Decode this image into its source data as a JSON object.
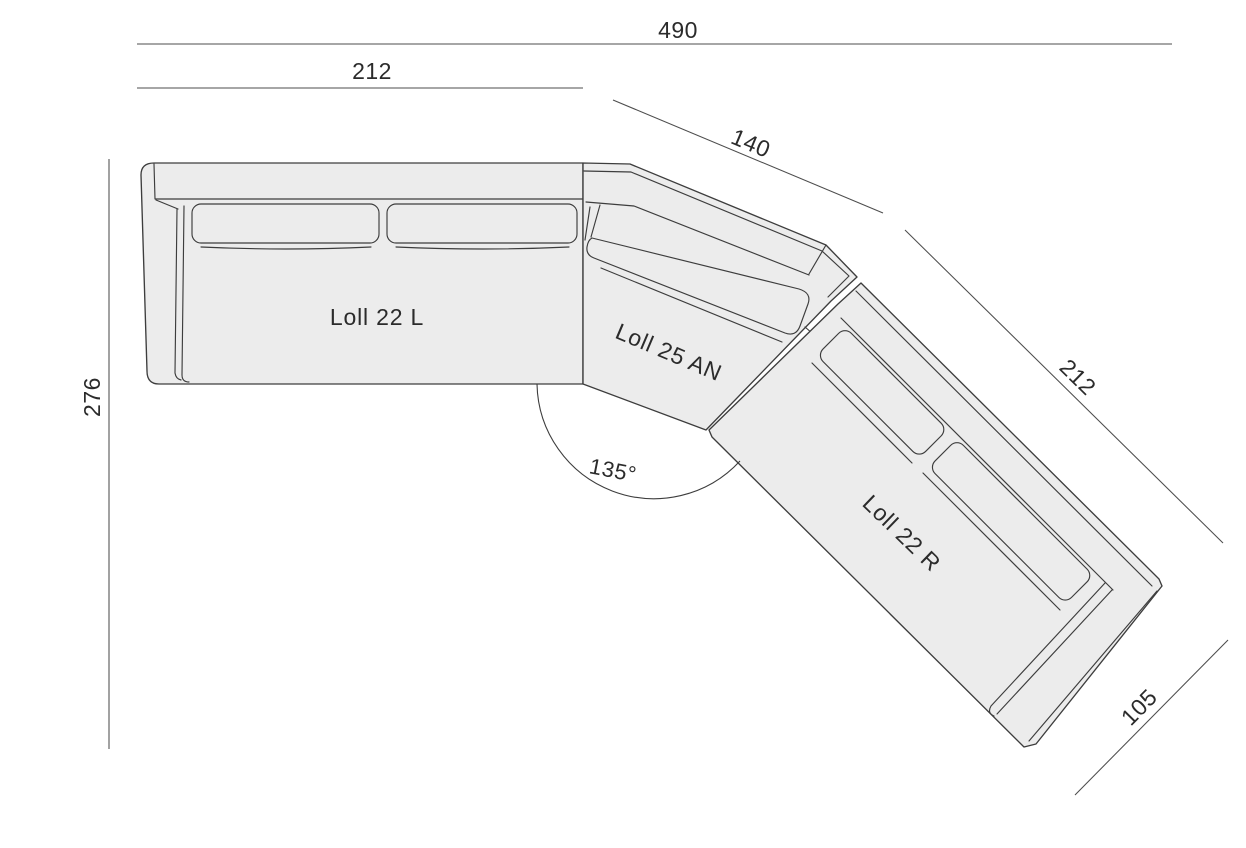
{
  "diagram": {
    "product_line": "Loll",
    "view": "sectional-sofa-top-view",
    "pieces": [
      {
        "id": "loll-22-l",
        "label": "Loll 22 L"
      },
      {
        "id": "loll-25-an",
        "label": "Loll 25 AN"
      },
      {
        "id": "loll-22-r",
        "label": "Loll 22 R"
      }
    ],
    "dimensions": {
      "overall_width": "490",
      "left_piece_width": "212",
      "corner_piece_width": "140",
      "right_piece_length": "212",
      "overall_depth": "276",
      "right_piece_depth": "105",
      "corner_angle": "135°"
    },
    "colors": {
      "background": "#ffffff",
      "piece_fill": "#ececec",
      "outline": "#3d3d3d",
      "dim_line": "#4d4d4d",
      "text": "#2b2b2b"
    }
  }
}
